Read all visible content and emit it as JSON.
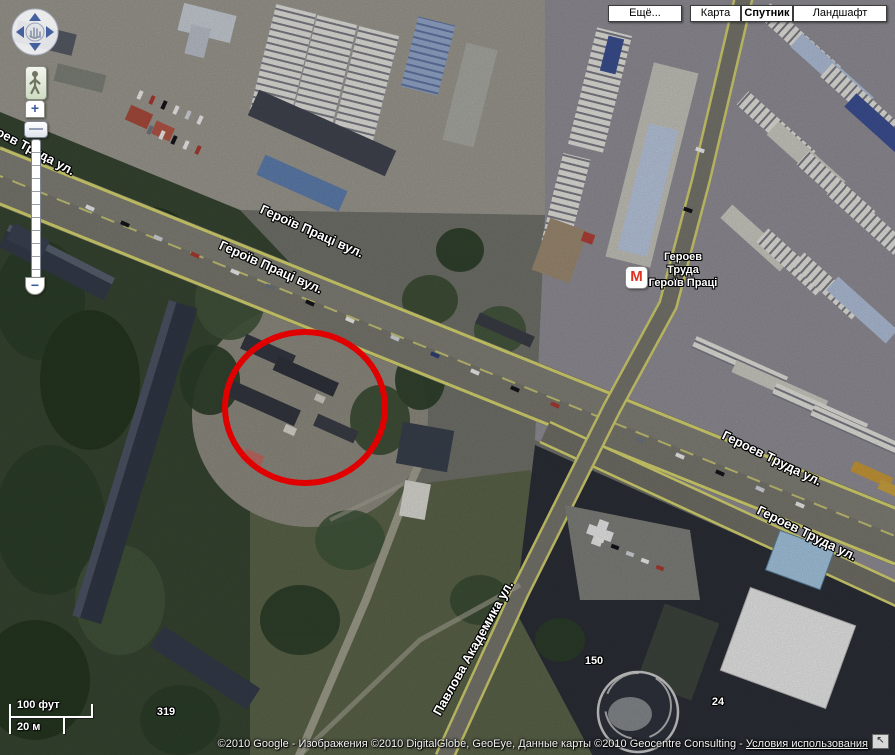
{
  "map_controls": {
    "more_button": "Ещё...",
    "map_button": "Карта",
    "satellite_button": "Спутник",
    "terrain_button": "Ландшафт",
    "selected": "Спутник"
  },
  "zoom_control": {
    "zoom_in": "+",
    "zoom_out": "−"
  },
  "scale_bar": {
    "imperial_label": "100 фут",
    "metric_label": "20 м"
  },
  "attribution": {
    "copyright_text": "©2010 Google - Изображения ©2010 DigitalGlobe, GeoEye, Данные карты ©2010 Geocentre Consulting - ",
    "terms_link": "Условия использования"
  },
  "street_labels": [
    {
      "text": "Героев Труда ул."
    },
    {
      "text": "Героїв Праці вул."
    },
    {
      "text": "Героїв Праці вул."
    },
    {
      "text": "Героев Труда ул."
    },
    {
      "text": "Героев Труда ул."
    },
    {
      "text": "Павлова Академика ул."
    }
  ],
  "house_numbers": [
    {
      "text": "319"
    },
    {
      "text": "150"
    },
    {
      "text": "24"
    }
  ],
  "metro_station": {
    "symbol": "M",
    "name_lines": [
      "Героев",
      "Труда",
      "Героїв Праці"
    ]
  },
  "icons": {
    "nw_arrow": "↖"
  },
  "annotation": {
    "shape": "ellipse",
    "color": "#e00000"
  },
  "colors": {
    "road_marking_yellow": "#d6d46e",
    "metro_red": "#e0301e",
    "annotation_red": "#e00000",
    "label_text": "#ffffff"
  }
}
